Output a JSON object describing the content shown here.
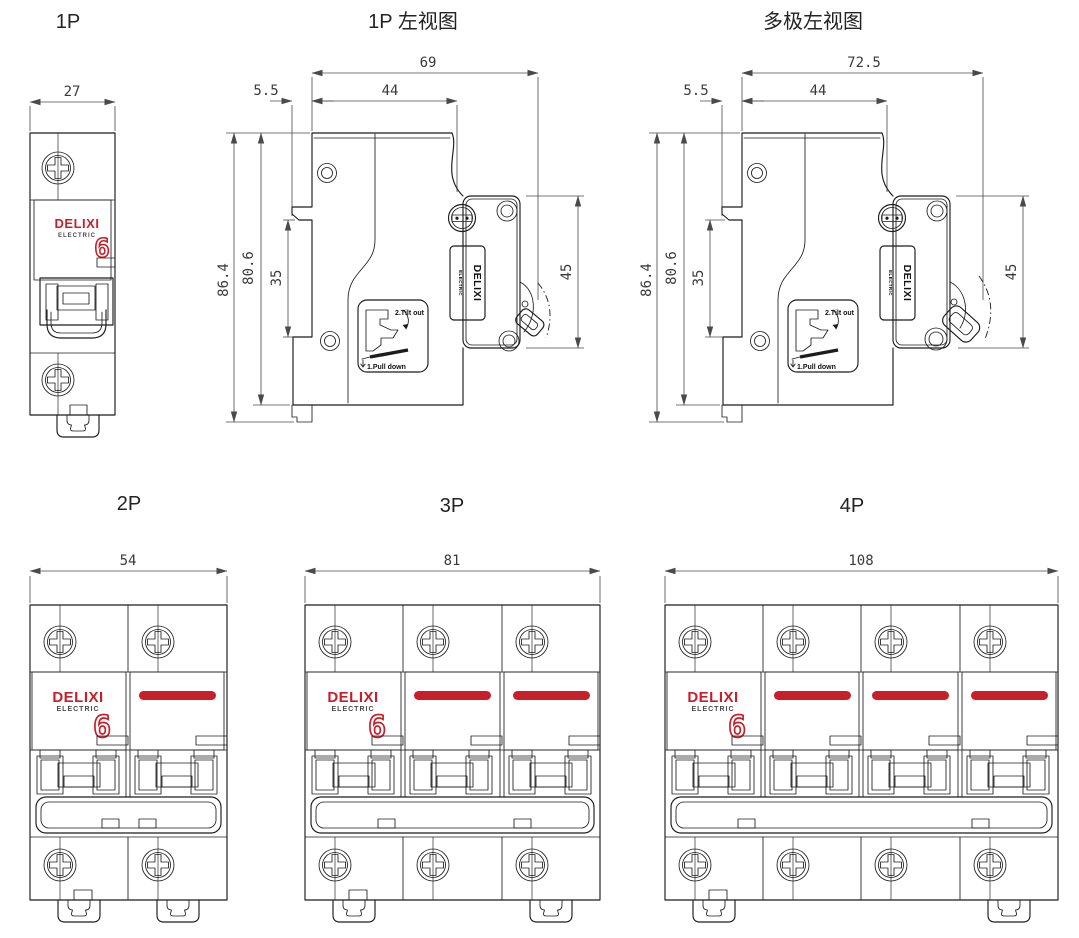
{
  "titles": {
    "front_1p": "1P",
    "side_1p": "1P 左视图",
    "side_multi": "多极左视图",
    "front_2p": "2P",
    "front_3p": "3P",
    "front_4p": "4P"
  },
  "dimensions": {
    "front_1p": {
      "width": "27"
    },
    "front_2p": {
      "width": "54"
    },
    "front_3p": {
      "width": "81"
    },
    "front_4p": {
      "width": "108"
    },
    "side_1p": {
      "overall_depth": "69",
      "din_clip_offset": "5.5",
      "body_depth": "44",
      "overall_height": "86.4",
      "body_height": "80.6",
      "din_rail_width": "35",
      "terminal_face_height": "45"
    },
    "side_multi": {
      "overall_depth": "72.5",
      "din_clip_offset": "5.5",
      "body_depth": "44",
      "overall_height": "86.4",
      "body_height": "80.6",
      "din_rail_width": "35",
      "terminal_face_height": "45"
    }
  },
  "branding": {
    "brand": "DELIXI",
    "sub_brand": "ELECTRIC",
    "rating_digit": "6"
  },
  "sticker": {
    "step_2": "2.Tilt out",
    "step_1": "1.Pull down"
  },
  "colors": {
    "brand_red": "#c8202a",
    "line": "#1c1c1c",
    "dim_text": "#3a3a3a",
    "background": "#ffffff"
  }
}
